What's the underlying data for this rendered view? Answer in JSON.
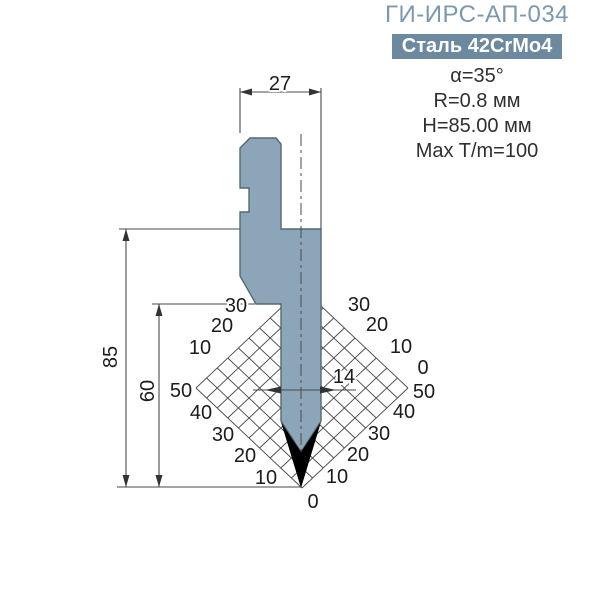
{
  "header": {
    "title": "ГИ-ИРС-АП-034",
    "material_badge": "Сталь 42CrMo4",
    "specs": [
      "α=35°",
      "R=0.8 мм",
      "H=85.00 мм",
      "Max T/m=100"
    ]
  },
  "colors": {
    "title": "#7d98ac",
    "badge_bg": "#6c89a0",
    "badge_text": "#ffffff",
    "spec_text": "#303030",
    "body_fill": "#8ca5b8",
    "body_stroke": "#566873",
    "line": "#4a4a4a",
    "tip": "#000000"
  },
  "diagram": {
    "dimensions": {
      "shank_width": "27",
      "total_height": "85",
      "working_height": "60",
      "tip_width": "14"
    },
    "grid": {
      "top": [
        302,
        288
      ],
      "right": [
        408,
        388
      ],
      "bottom": [
        302,
        488
      ],
      "left": [
        196,
        388
      ],
      "divisions": 10
    },
    "scale_labels": [
      {
        "text": "30",
        "x": 236,
        "y": 306
      },
      {
        "text": "20",
        "x": 222,
        "y": 326
      },
      {
        "text": "10",
        "x": 200,
        "y": 348
      },
      {
        "text": "50",
        "x": 181,
        "y": 391
      },
      {
        "text": "40",
        "x": 201,
        "y": 413
      },
      {
        "text": "30",
        "x": 223,
        "y": 435
      },
      {
        "text": "20",
        "x": 245,
        "y": 456
      },
      {
        "text": "10",
        "x": 266,
        "y": 478
      },
      {
        "text": "0",
        "x": 313,
        "y": 502
      },
      {
        "text": "30",
        "x": 359,
        "y": 305
      },
      {
        "text": "20",
        "x": 377,
        "y": 325
      },
      {
        "text": "10",
        "x": 401,
        "y": 347
      },
      {
        "text": "0",
        "x": 423,
        "y": 368
      },
      {
        "text": "50",
        "x": 424,
        "y": 392
      },
      {
        "text": "40",
        "x": 404,
        "y": 412
      },
      {
        "text": "30",
        "x": 379,
        "y": 434
      },
      {
        "text": "20",
        "x": 358,
        "y": 455
      },
      {
        "text": "10",
        "x": 337,
        "y": 477
      }
    ]
  }
}
